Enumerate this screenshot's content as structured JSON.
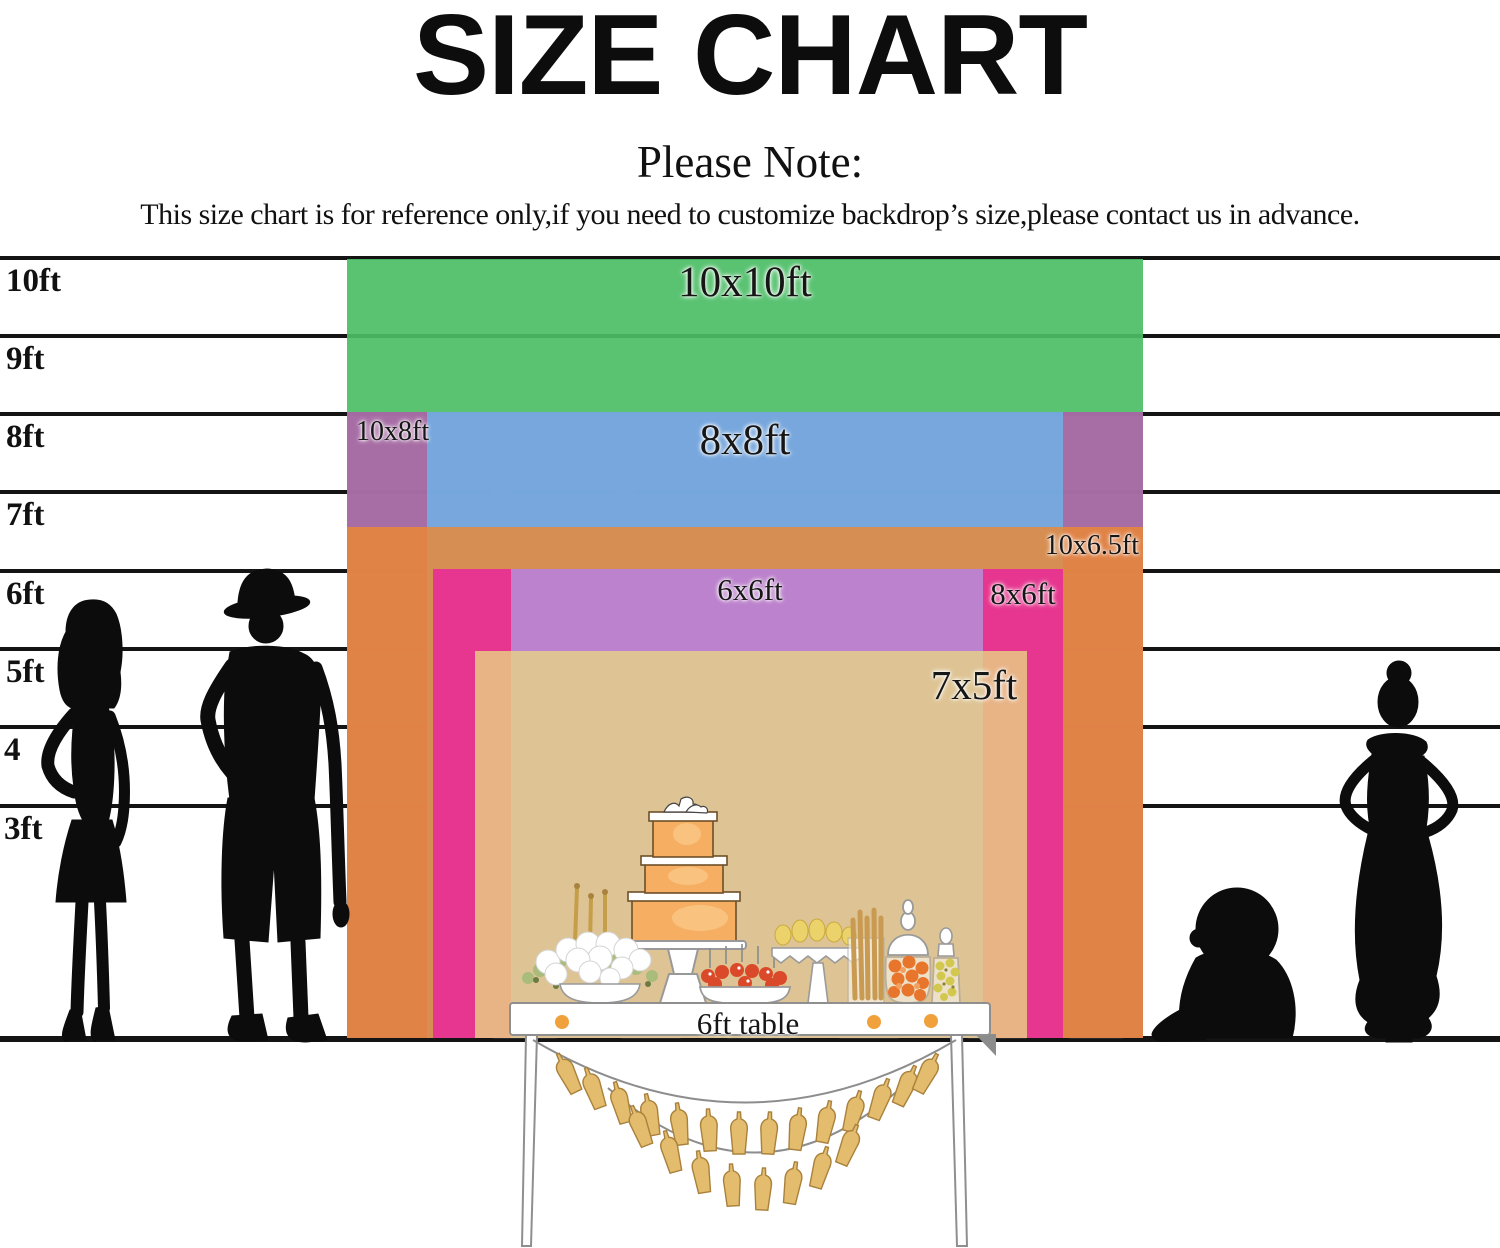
{
  "title": "SIZE CHART",
  "note": {
    "heading": "Please Note:",
    "body": "This size chart is for reference only,if you need to customize backdrop’s size,please contact us in advance."
  },
  "ruler": {
    "unit": "ft",
    "labels": [
      "10ft",
      "9ft",
      "8ft",
      "7ft",
      "6ft",
      "5ft",
      "4",
      "3ft"
    ]
  },
  "sizes": [
    {
      "label": "10x10ft",
      "width_ft": 10,
      "height_ft": 10,
      "color": "#4cbe66"
    },
    {
      "label": "10x8ft",
      "width_ft": 10,
      "height_ft": 8,
      "color": "#b55fae"
    },
    {
      "label": "8x8ft",
      "width_ft": 8,
      "height_ft": 8,
      "color": "#6fb1e6"
    },
    {
      "label": "10x6.5ft",
      "width_ft": 10,
      "height_ft": 6.5,
      "color": "#ef8830"
    },
    {
      "label": "8x6ft",
      "width_ft": 8,
      "height_ft": 6,
      "color": "#e82c96"
    },
    {
      "label": "6x6ft",
      "width_ft": 6,
      "height_ft": 6,
      "color": "#b48fd8"
    },
    {
      "label": "7x5ft",
      "width_ft": 7,
      "height_ft": 5,
      "color": "#e8d784"
    }
  ],
  "table": {
    "label": "6ft table"
  }
}
